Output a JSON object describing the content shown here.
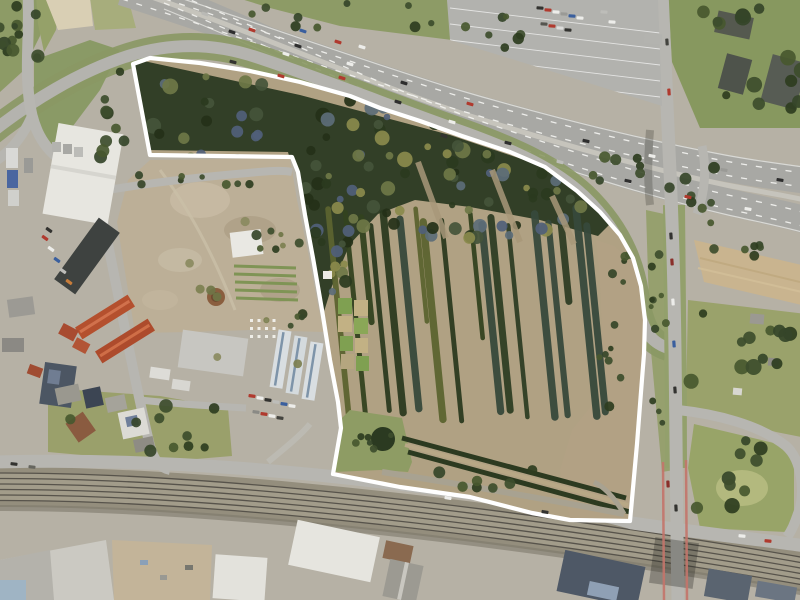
{
  "scene": {
    "type": "aerial-orthophoto",
    "description": "Aerial photograph of an urban-fringe parcel: a white boundary outlines a former tree-nursery site bounded by a motorway at top, a railway corridor at bottom, an industrial and residential block to the west and a road junction to the east.",
    "overlay_name": "site-boundary"
  },
  "palette": {
    "base": "#b6b1a5",
    "boundary_white": "#ffffff",
    "motorway": "#a8a8a4",
    "motorway_median": "#c6c4bc",
    "lane_marking": "#f5f5f2",
    "frontage_road": "#b4b3ae",
    "local_road": "#b7b6b1",
    "rail_bed": "#948e7d",
    "rail_gravel": "#a29c8a",
    "rail_track": "#57534b",
    "parking": "#b2b2ae",
    "site_scrub": "#b0a183",
    "woodland": "#323f27",
    "east_scrub": "#b2a184",
    "lawn": "#8e9c64",
    "grass_verge": "#8a9864",
    "green_area": "#8d9b66",
    "allotment_green": "#9aa26b",
    "triangle_green": "#98a468",
    "field_tan": "#c9b48f",
    "scrub_field": "#bcaf97",
    "sand": "#d9cfb4",
    "white_roof": "#e7e6e0",
    "dark_roof": "#3e4240",
    "red_roof": "#b4502e",
    "blue_roof": "#4c5663",
    "bridge_red": "#c4756b",
    "hedge_dark": "#2c3a20",
    "hedge_gap": "#b8a886",
    "inner_drive": "#a8a291"
  },
  "site_boundary_points": "133,64 150,58 200,63 250,71 300,82 350,96 380,108 420,121 462,136 510,152 545,167 577,191 600,212 620,235 633,258 641,286 645,320 644,354 641,392 637,444 633,488 630,521 570,520 532,513 470,497 400,487 333,474 341,428 338,402 330,360 322,310 313,258 305,215 298,172 292,157 150,155",
  "nursery_rows": {
    "x_start": 332,
    "x_end": 595,
    "spacing": 13.5,
    "tilt": 0.1,
    "y_top": 208,
    "y_bottom": 428,
    "gap_ranges": [
      [
        448,
        466
      ],
      [
        516,
        532
      ]
    ],
    "colors": [
      "#2c3a1f",
      "#33431f",
      "#5c6430",
      "#37493b",
      "#2f3e24"
    ],
    "width_min": 4.5,
    "width_max": 7.5
  },
  "railway": {
    "track_offsets": [
      -14,
      -8.5,
      -3,
      2.5,
      8,
      13.5
    ]
  },
  "parking_rows": 6,
  "hive_grid": {
    "x": 250,
    "y": 319,
    "cols": 4,
    "rows": 3,
    "dx": 7.5,
    "dy": 8,
    "size": 3
  },
  "tree_colors": {
    "dark": [
      "#3d4d2c",
      "#2e3d20",
      "#48582f",
      "#354529"
    ],
    "mixed": [
      "#2a3a1e",
      "#44543a",
      "#5c6c78",
      "#6e7747",
      "#8a8a4c",
      "#243018",
      "#50607a"
    ],
    "olive": [
      "#7d8050",
      "#8a8a60",
      "#6f7547"
    ]
  },
  "tree_clusters": [
    {
      "cx": 20,
      "cy": 45,
      "rx": 20,
      "ry": 36,
      "n": 8,
      "rmin": 4,
      "rmax": 8,
      "set": "dark"
    },
    {
      "cx": 8,
      "cy": 28,
      "rx": 10,
      "ry": 26,
      "n": 5,
      "rmin": 3,
      "rmax": 6,
      "set": "dark"
    },
    {
      "cx": 110,
      "cy": 112,
      "rx": 15,
      "ry": 50,
      "n": 9,
      "rmin": 4,
      "rmax": 7,
      "set": "dark"
    },
    {
      "cx": 206,
      "cy": 180,
      "rx": 76,
      "ry": 5,
      "n": 8,
      "rmin": 2.5,
      "rmax": 4.5,
      "set": "dark"
    },
    {
      "cx": 345,
      "cy": 15,
      "rx": 95,
      "ry": 13,
      "n": 9,
      "rmin": 3,
      "rmax": 6,
      "set": "dark"
    },
    {
      "cx": 753,
      "cy": 62,
      "rx": 50,
      "ry": 54,
      "n": 14,
      "rmin": 4,
      "rmax": 9,
      "set": "dark"
    },
    {
      "cx": 745,
      "cy": 352,
      "rx": 54,
      "ry": 46,
      "n": 12,
      "rmin": 4,
      "rmax": 8,
      "set": "dark"
    },
    {
      "cx": 740,
      "cy": 472,
      "rx": 46,
      "ry": 38,
      "n": 9,
      "rmin": 4,
      "rmax": 8,
      "set": "dark"
    },
    {
      "cx": 658,
      "cy": 330,
      "rx": 8,
      "ry": 105,
      "n": 11,
      "rmin": 2.5,
      "rmax": 5,
      "set": "dark"
    },
    {
      "cx": 484,
      "cy": 479,
      "rx": 50,
      "ry": 10,
      "n": 7,
      "rmin": 3,
      "rmax": 6,
      "set": "dark"
    },
    {
      "cx": 142,
      "cy": 426,
      "rx": 84,
      "ry": 26,
      "n": 10,
      "rmin": 3,
      "rmax": 7,
      "set": "dark"
    },
    {
      "cx": 748,
      "cy": 252,
      "rx": 50,
      "ry": 7,
      "n": 6,
      "rmin": 3,
      "rmax": 5,
      "set": "dark"
    },
    {
      "cx": 267,
      "cy": 242,
      "rx": 42,
      "ry": 15,
      "n": 5,
      "rmin": 3,
      "rmax": 6,
      "set": "dark"
    },
    {
      "cx": 242,
      "cy": 282,
      "rx": 66,
      "ry": 82,
      "n": 10,
      "rmin": 2.5,
      "rmax": 5,
      "set": "olive"
    },
    {
      "cx": 378,
      "cy": 441,
      "rx": 25,
      "ry": 12,
      "n": 6,
      "rmin": 2.5,
      "rmax": 4,
      "set": "dark"
    },
    {
      "cx": 487,
      "cy": 34,
      "rx": 36,
      "ry": 22,
      "n": 7,
      "rmin": 3,
      "rmax": 6,
      "set": "dark"
    },
    {
      "cx": 690,
      "cy": 192,
      "rx": 25,
      "ry": 34,
      "n": 8,
      "rmin": 3,
      "rmax": 6,
      "set": "dark"
    },
    {
      "cx": 615,
      "cy": 175,
      "rx": 26,
      "ry": 20,
      "n": 7,
      "rmin": 3,
      "rmax": 6,
      "set": "dark"
    },
    {
      "cx": 300,
      "cy": 322,
      "rx": 11,
      "ry": 9,
      "n": 4,
      "rmin": 2.5,
      "rmax": 5,
      "set": "dark"
    }
  ],
  "site_tree_clusters": [
    {
      "cx": 355,
      "cy": 132,
      "rx": 228,
      "ry": 58,
      "n": 85,
      "rmin": 3,
      "rmax": 8,
      "set": "mixed"
    },
    {
      "cx": 330,
      "cy": 225,
      "rx": 35,
      "ry": 75,
      "n": 30,
      "rmin": 3,
      "rmax": 7,
      "set": "mixed"
    },
    {
      "cx": 470,
      "cy": 215,
      "rx": 120,
      "ry": 25,
      "n": 30,
      "rmin": 3,
      "rmax": 7,
      "set": "mixed"
    },
    {
      "cx": 612,
      "cy": 330,
      "rx": 18,
      "ry": 86,
      "n": 12,
      "rmin": 2.5,
      "rmax": 5,
      "set": "dark"
    }
  ],
  "cars": [
    [
      205,
      14,
      19,
      "#b9b9b5"
    ],
    [
      252,
      30,
      19,
      "#b03a2e"
    ],
    [
      298,
      46,
      18,
      "#2e2e2e"
    ],
    [
      350,
      64,
      17,
      "#ededea"
    ],
    [
      404,
      83,
      17,
      "#2e2e2e"
    ],
    [
      470,
      104,
      16,
      "#b03a2e"
    ],
    [
      586,
      141,
      13,
      "#2e2e2e"
    ],
    [
      652,
      156,
      12,
      "#ededea"
    ],
    [
      724,
      170,
      10,
      "#9a9a96"
    ],
    [
      780,
      180,
      9,
      "#2e2e2e"
    ],
    [
      303,
      31,
      18,
      "#3a5f9e"
    ],
    [
      338,
      42,
      17,
      "#b03a2e"
    ],
    [
      362,
      47,
      17,
      "#ededea"
    ],
    [
      232,
      32,
      19,
      "#2e2e2e"
    ],
    [
      286,
      54,
      18,
      "#ededea"
    ],
    [
      342,
      78,
      17,
      "#b03a2e"
    ],
    [
      398,
      102,
      17,
      "#2e2e2e"
    ],
    [
      452,
      122,
      16,
      "#ededea"
    ],
    [
      508,
      143,
      15,
      "#2e2e2e"
    ],
    [
      560,
      162,
      14,
      "#bdbdb9"
    ],
    [
      628,
      181,
      13,
      "#2e2e2e"
    ],
    [
      688,
      197,
      11,
      "#b03a2e"
    ],
    [
      748,
      209,
      10,
      "#ededea"
    ],
    [
      233,
      62,
      14,
      "#333330"
    ],
    [
      281,
      76,
      16,
      "#b03a2e"
    ],
    [
      444,
      136,
      17,
      "#333330"
    ],
    [
      667,
      42,
      86,
      "#44443f"
    ],
    [
      669,
      92,
      86,
      "#b03a2e"
    ],
    [
      671,
      236,
      86,
      "#333330"
    ],
    [
      672,
      262,
      86,
      "#8a2f2a"
    ],
    [
      673,
      302,
      86,
      "#ededea"
    ],
    [
      674,
      344,
      86,
      "#3a5f9e"
    ],
    [
      675,
      390,
      86,
      "#333330"
    ],
    [
      668,
      484,
      87,
      "#8a2f2a"
    ],
    [
      676,
      508,
      87,
      "#333330"
    ],
    [
      14,
      464,
      6,
      "#333330"
    ],
    [
      32,
      467,
      6,
      "#66665f"
    ],
    [
      448,
      498,
      9,
      "#ededea"
    ],
    [
      545,
      512,
      10,
      "#333330"
    ],
    [
      742,
      536,
      5,
      "#ededea"
    ],
    [
      768,
      541,
      5,
      "#b03a2e"
    ],
    [
      540,
      8,
      4,
      "#333330"
    ],
    [
      548,
      10,
      4,
      "#b03a2e"
    ],
    [
      556,
      12,
      4,
      "#ededea"
    ],
    [
      564,
      14,
      4,
      "#9a9a96"
    ],
    [
      572,
      16,
      4,
      "#3a5f9e"
    ],
    [
      580,
      18,
      4,
      "#ededea"
    ],
    [
      544,
      24,
      4,
      "#55554f"
    ],
    [
      552,
      26,
      4,
      "#b03a2e"
    ],
    [
      560,
      28,
      4,
      "#dddddb"
    ],
    [
      568,
      30,
      4,
      "#333330"
    ],
    [
      604,
      12,
      4,
      "#bdbdb9"
    ],
    [
      612,
      22,
      4,
      "#ededea"
    ],
    [
      45,
      238,
      36,
      "#b03a2e"
    ],
    [
      51,
      249,
      36,
      "#ededea"
    ],
    [
      57,
      260,
      36,
      "#3a5f9e"
    ],
    [
      63,
      271,
      36,
      "#bdbdb9"
    ],
    [
      49,
      230,
      36,
      "#333330"
    ],
    [
      69,
      282,
      36,
      "#c77c3a"
    ],
    [
      252,
      396,
      8,
      "#b03a2e"
    ],
    [
      260,
      398,
      8,
      "#ededea"
    ],
    [
      268,
      400,
      8,
      "#333330"
    ],
    [
      276,
      402,
      8,
      "#bdbdb9"
    ],
    [
      284,
      404,
      8,
      "#3a5f9e"
    ],
    [
      292,
      406,
      8,
      "#ededea"
    ],
    [
      256,
      412,
      8,
      "#8a8a85"
    ],
    [
      264,
      414,
      8,
      "#b03a2e"
    ],
    [
      272,
      416,
      8,
      "#ededea"
    ],
    [
      280,
      418,
      8,
      "#44443f"
    ]
  ]
}
